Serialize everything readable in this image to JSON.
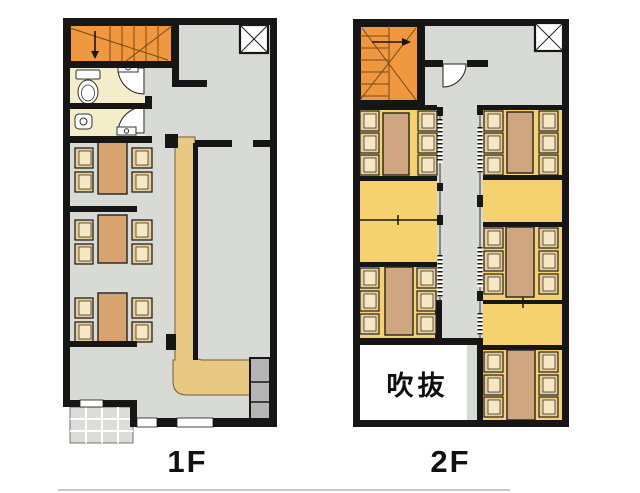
{
  "page": {
    "background": "#ffffff",
    "type": "restaurant-floor-plan"
  },
  "palette": {
    "wall_black": "#161616",
    "floor_gray": "#d8dad5",
    "stairs_orange": "#ef9840",
    "tatami_yellow": "#f6d26f",
    "toilet_cream": "#f3edca",
    "counter_tan": "#e8c883",
    "table_brown_1f": "#d7a36e",
    "table_brown_2f": "#cfa680",
    "chair_tan": "#e9cd94",
    "chair_inner": "#f6e8c4",
    "cabinet_gray": "#b5b5b5",
    "entrance_tile_gray": "#dcdcd8",
    "void_white": "#ffffff"
  },
  "icons": {
    "shaft-x-icon": "white box with diagonal cross",
    "staircase-icon": "orange stair with treads, break lines and direction arrow",
    "door-swing-icon": "white quarter-circle door swing",
    "sliding-door-icon": "dashed ladder hatch along corridor",
    "toilet-icon": "tank + bowl",
    "urinal-icon": "small basin",
    "sink-icon": "small rectangle with faucet circle"
  },
  "floor1": {
    "label": "1F",
    "components": {
      "staircase_down": 1,
      "toilet_rooms": 2,
      "shaft_boxes": 1,
      "dining_booths": 3,
      "seats_per_booth": 4,
      "l_shaped_counter": 1,
      "cabinet_unit": 1,
      "entrance_tiled_area": 1,
      "window_openings": 2
    }
  },
  "floor2": {
    "label": "2F",
    "void_label": "吹抜",
    "components": {
      "staircase_up": 1,
      "entry_door": 1,
      "shaft_boxes": 1,
      "tatami_tables": 5,
      "seats_per_table": 6,
      "sliding_door_sections": 5,
      "void_room": 1
    }
  }
}
